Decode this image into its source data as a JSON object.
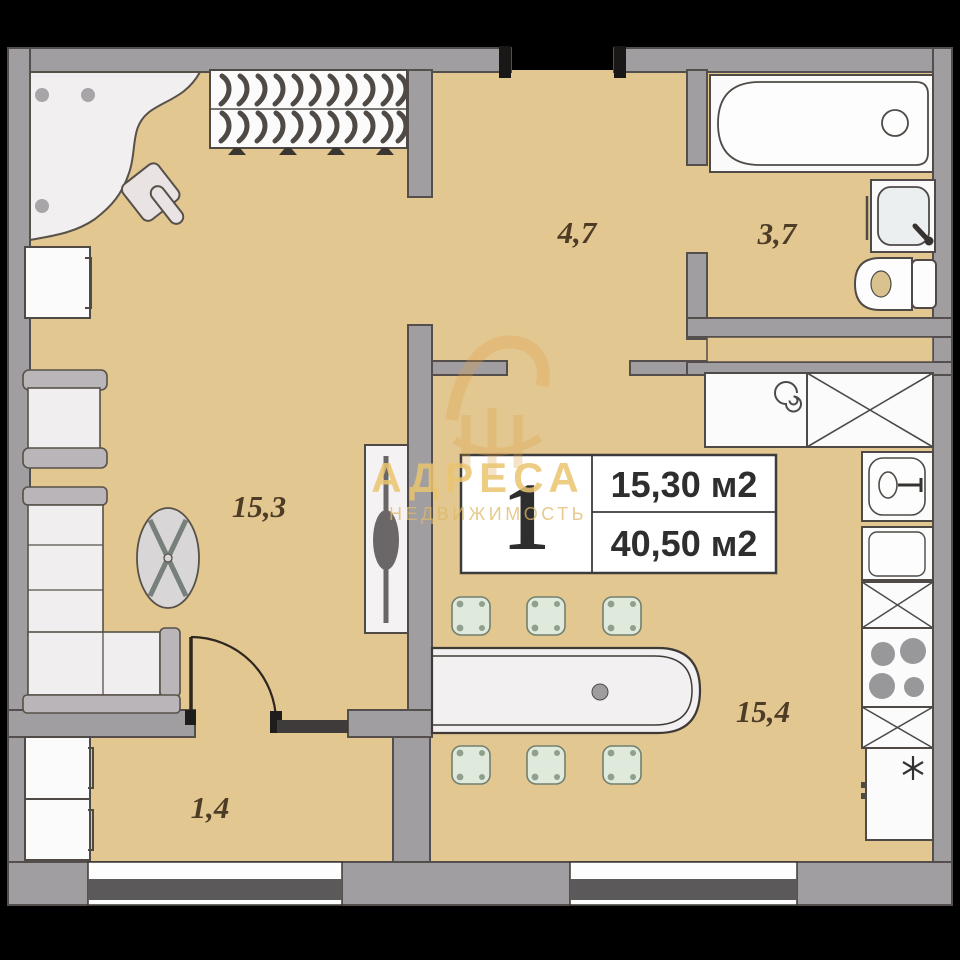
{
  "unit_card": {
    "rooms_count": "1",
    "area_line1": "15,30 м2",
    "area_line2": "40,50 м2"
  },
  "room_labels": {
    "living": "15,3",
    "hall": "4,7",
    "bathroom": "3,7",
    "kitchen": "15,4",
    "balcony": "1,4"
  },
  "watermark": {
    "brand": "АДРЕСА",
    "tagline": "НЕДВИЖИМОСТЬ"
  },
  "colors": {
    "floor": "#e3c791",
    "wall": "#a19ea1",
    "wall_outline": "#544f4c",
    "furniture_white": "#fafafa",
    "bar_chair_green": "#dfe9dc",
    "brand_gold": "#eac56f",
    "label_brown": "#4d3c26",
    "window_stripe": "#5b595a"
  }
}
